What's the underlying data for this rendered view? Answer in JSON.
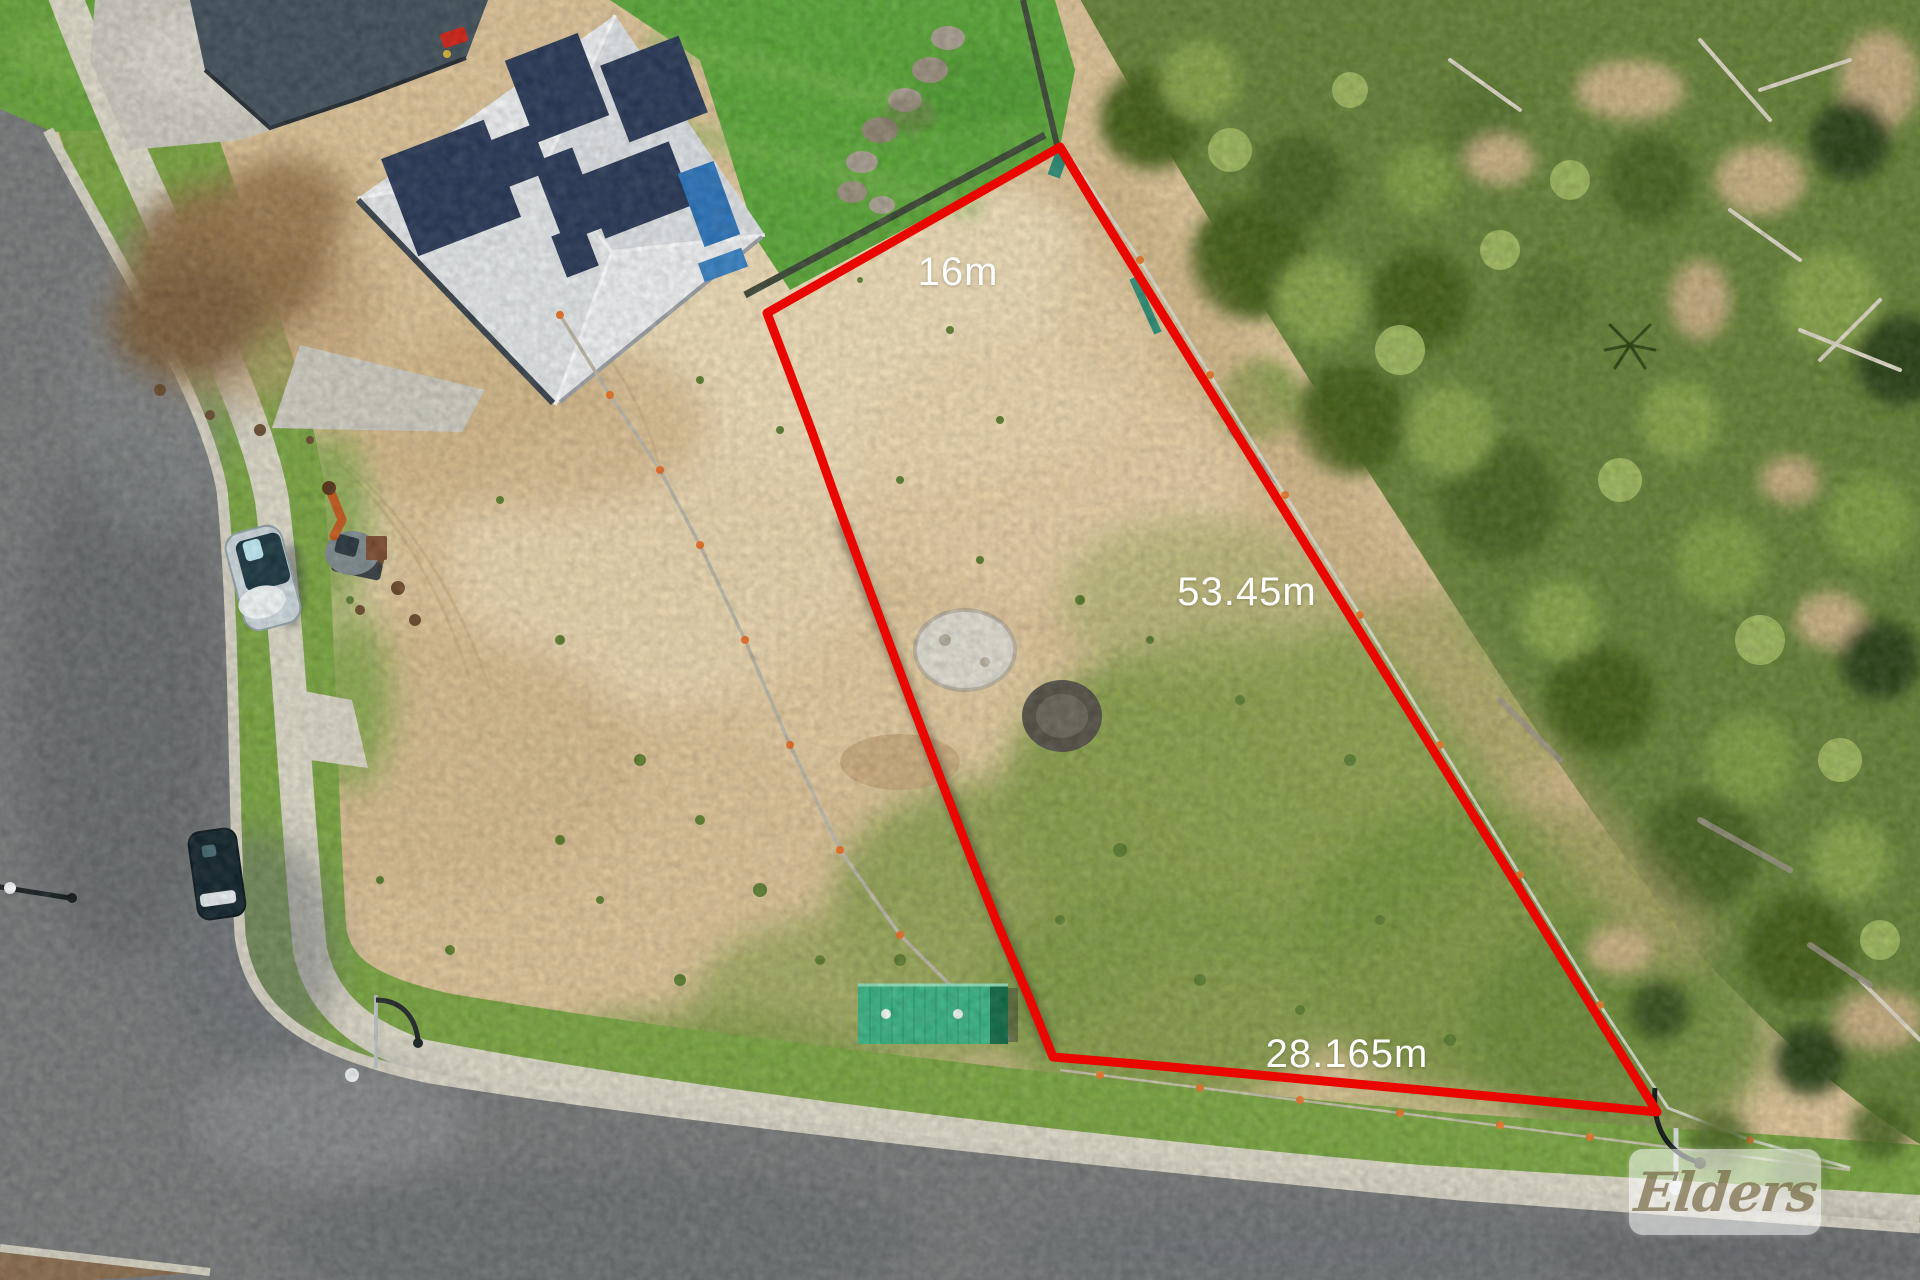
{
  "lot": {
    "outline_color": "#e90700",
    "measurements": {
      "top_edge": "16m",
      "right_edge": "53.45m",
      "bottom_edge": "28.165m"
    }
  },
  "watermark": {
    "text": "Elders",
    "panel_color": "rgba(255,255,255,0.55)",
    "text_color": "rgba(104,88,48,0.62)"
  }
}
